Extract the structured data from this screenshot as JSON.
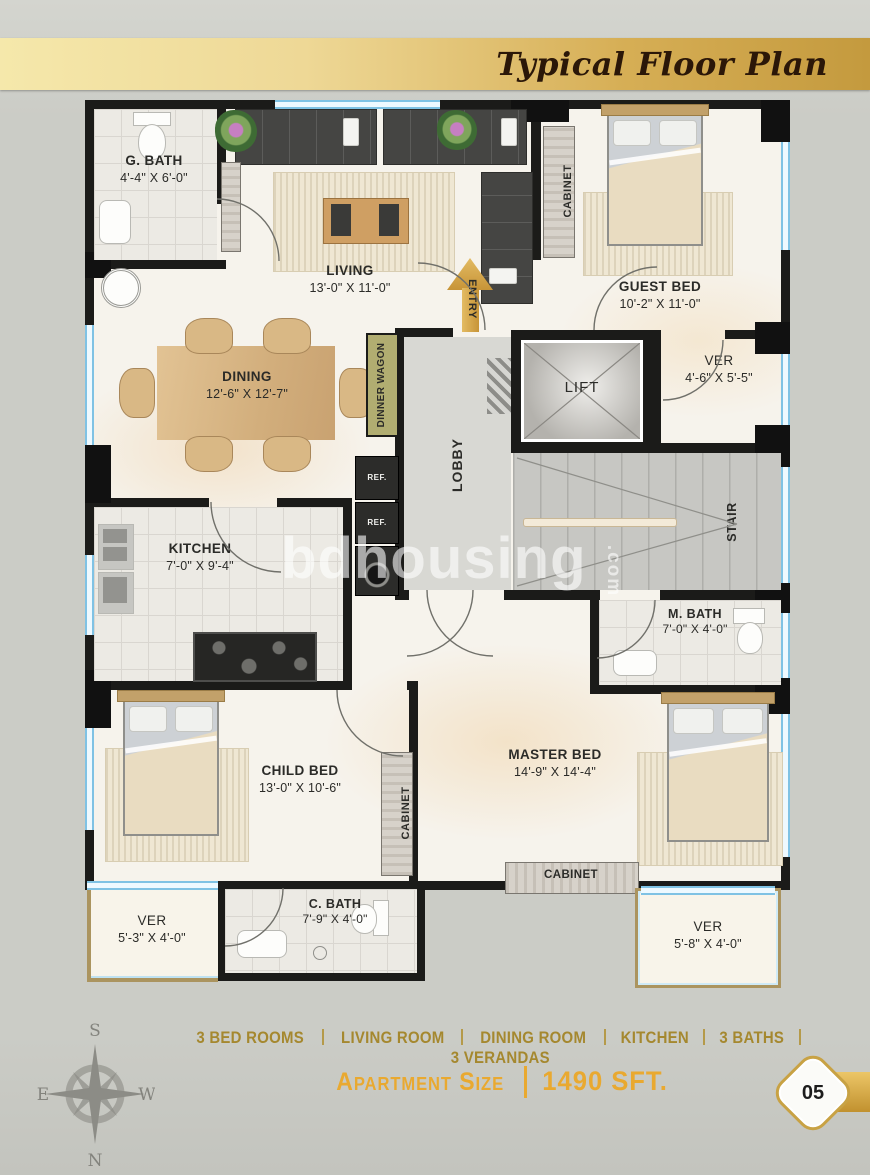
{
  "header": {
    "title": "Typical Floor Plan"
  },
  "plan": {
    "watermark": "bdhousing",
    "watermark_suffix": ".com",
    "rooms": {
      "g_bath": {
        "name": "G. BATH",
        "dim": "4'-4\" X 6'-0\""
      },
      "living": {
        "name": "LIVING",
        "dim": "13'-0\" X 11'-0\""
      },
      "guest_bed": {
        "name": "GUEST BED",
        "dim": "10'-2\" X 11'-0\""
      },
      "dining": {
        "name": "DINING",
        "dim": "12'-6\" X 12'-7\""
      },
      "ver_top": {
        "name": "VER",
        "dim": "4'-6\" X 5'-5\""
      },
      "kitchen": {
        "name": "KITCHEN",
        "dim": "7'-0\" X 9'-4\""
      },
      "m_bath": {
        "name": "M. BATH",
        "dim": "7'-0\" X 4'-0\""
      },
      "child_bed": {
        "name": "CHILD BED",
        "dim": "13'-0\" X 10'-6\""
      },
      "master_bed": {
        "name": "MASTER BED",
        "dim": "14'-9\" X 14'-4\""
      },
      "ver_left": {
        "name": "VER",
        "dim": "5'-3\" X 4'-0\""
      },
      "c_bath": {
        "name": "C. BATH",
        "dim": "7'-9\" X 4'-0\""
      },
      "ver_right": {
        "name": "VER",
        "dim": "5'-8\" X 4'-0\""
      }
    },
    "labels": {
      "entry": "ENTRY",
      "lobby": "LOBBY",
      "lift": "LIFT",
      "stair": "STAIR",
      "dinner_wagon": "DINNER WAGON",
      "cabinet": "CABINET",
      "ref": "REF."
    }
  },
  "footer": {
    "features": [
      "3 BED ROOMS",
      "LIVING ROOM",
      "DINING ROOM",
      "KITCHEN",
      "3 BATHS",
      "3 VERANDAS"
    ],
    "apartment_size_label": "Apartment Size",
    "apartment_size_value": "1490 SFT.",
    "page_number": "05",
    "compass": {
      "top": "S",
      "bottom": "N",
      "left": "E",
      "right": "W"
    }
  },
  "colors": {
    "banner_gold": "#d6ae55",
    "accent_gold": "#e9a930",
    "feature_text": "#a5882f",
    "wall": "#1b1b19",
    "window_blue": "#7fc2e4",
    "floor_cream": "#f6f3ec"
  }
}
